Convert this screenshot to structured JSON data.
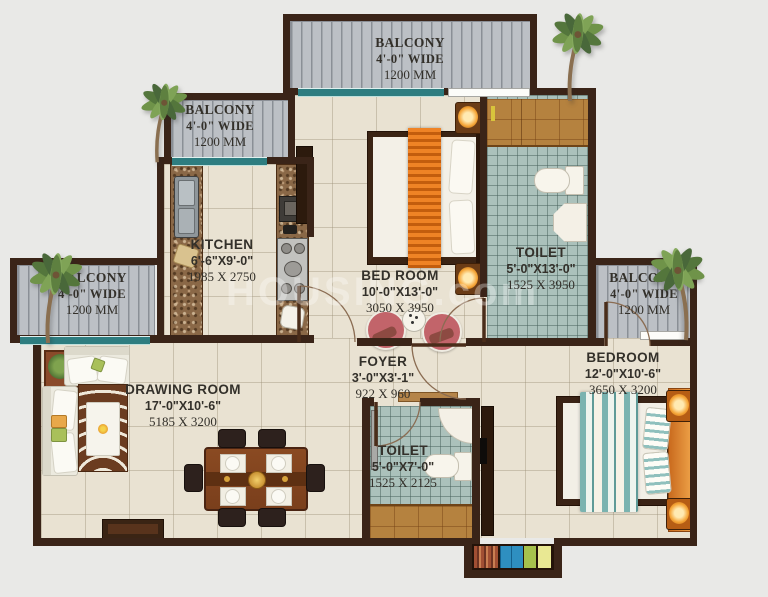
{
  "watermark": "HOUSING.com",
  "palette": {
    "background": "#e9e9e7",
    "wall": "#3a2418",
    "floor": "#e9e2d2",
    "toilet_tile": "#abc1bb",
    "balcony_floor": "#bcc0c5",
    "glazing_teal": "#2e7d80",
    "bed_runner_orange": "#ef8325",
    "duvet_teal": "#7ab3b0",
    "headboard_orange": "#e08a2e",
    "label_text": "#33302a"
  },
  "rooms": {
    "balcony_top": {
      "name": "BALCONY",
      "dims_ft": "4'-0\" WIDE",
      "dims_mm": "1200 MM"
    },
    "balcony_upper_left": {
      "name": "BALCONY",
      "dims_ft": "4'-0\" WIDE",
      "dims_mm": "1200 MM"
    },
    "balcony_left": {
      "name": "BALCONY",
      "dims_ft": "4'-0\" WIDE",
      "dims_mm": "1200 MM"
    },
    "balcony_right": {
      "name": "BALCONY",
      "dims_ft": "4'-0\" WIDE",
      "dims_mm": "1200 MM"
    },
    "kitchen": {
      "name": "KITCHEN",
      "dims_ft": "6'-6\"X9'-0\"",
      "dims_mm": "1985 X 2750"
    },
    "bed_room": {
      "name": "BED ROOM",
      "dims_ft": "10'-0\"X13'-0\"",
      "dims_mm": "3050 X 3950"
    },
    "toilet_top": {
      "name": "TOILET",
      "dims_ft": "5'-0\"X13'-0\"",
      "dims_mm": "1525 X 3950"
    },
    "drawing_room": {
      "name": "DRAWING ROOM",
      "dims_ft": "17'-0\"X10'-6\"",
      "dims_mm": "5185 X 3200"
    },
    "foyer": {
      "name": "FOYER",
      "dims_ft": "3'-0\"X3'-1\"",
      "dims_mm": "922 X 960"
    },
    "toilet_bottom": {
      "name": "TOILET",
      "dims_ft": "5'-0\"X7'-0\"",
      "dims_mm": "1525 X 2125"
    },
    "bedroom_right": {
      "name": "BEDROOM",
      "dims_ft": "12'-0\"X10'-6\"",
      "dims_mm": "3650 X 3200"
    }
  }
}
